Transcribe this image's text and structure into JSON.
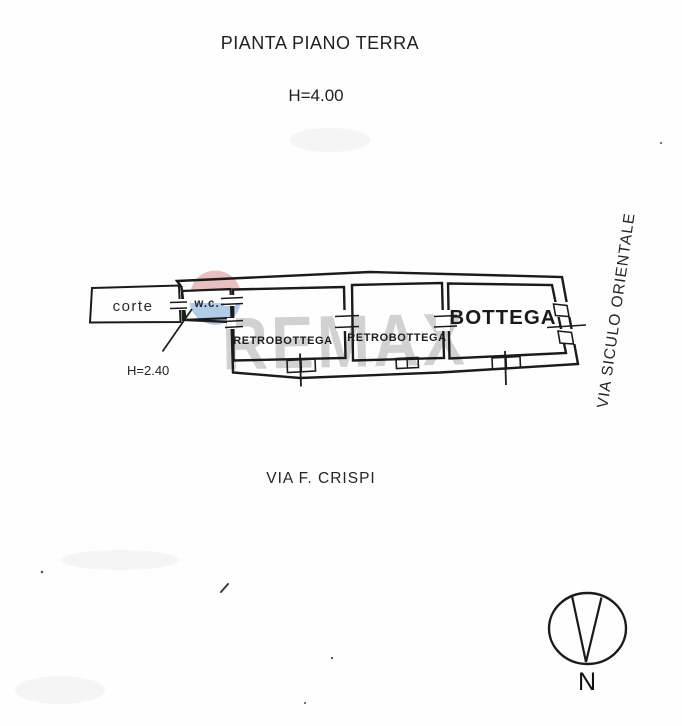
{
  "document": {
    "title": "PIANTA PIANO TERRA",
    "floor_height_label": "H=4.00"
  },
  "plan": {
    "rooms": {
      "corte": "corte",
      "wc": "w.c.",
      "retrobottega_1": "RETROBOTTEGA",
      "retrobottega_2": "RETROBOTTEGA",
      "bottega": "BOTTEGA"
    },
    "wc_height_label": "H=2.40",
    "streets": {
      "right_vertical": "VIA SICULO ORIENTALE",
      "bottom": "VIA F. CRISPI"
    },
    "compass": {
      "north_label": "N"
    },
    "watermark": {
      "text": "REMAX",
      "text_color": "#c7c7c7",
      "balloon_red": "#d48080",
      "balloon_blue": "#7fa9d6"
    },
    "ink_color": "#1b1b1b"
  }
}
